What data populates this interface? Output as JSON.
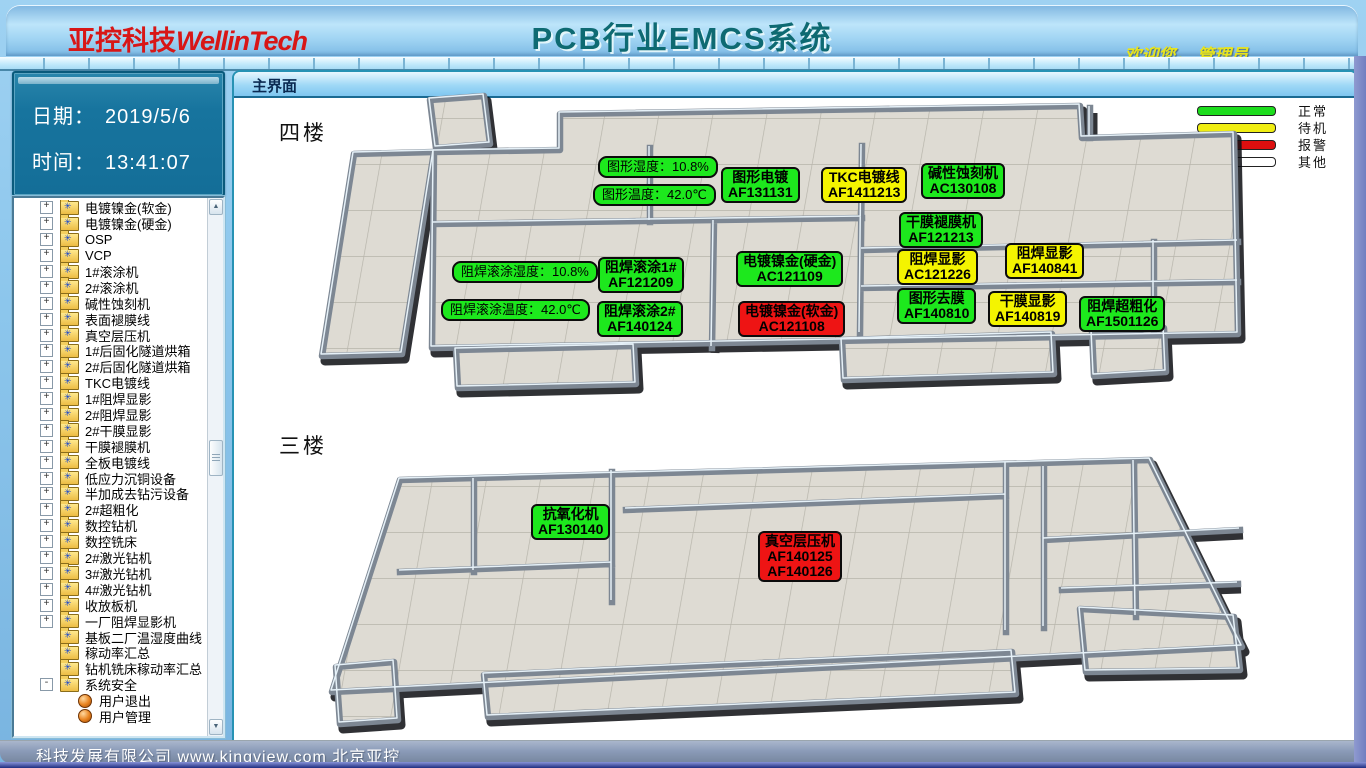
{
  "header": {
    "logo_cn": "亚控科技",
    "logo_en": "WellinTech",
    "title": "PCB行业EMCS系统",
    "welcome": "欢迎您， 管理员"
  },
  "info_panel": {
    "date_label": "日期：",
    "date_value": "2019/5/6",
    "time_label": "时间：",
    "time_value": "13:41:07"
  },
  "tree": {
    "items": [
      {
        "label": "电镀镍金(软金)",
        "icon": "folder",
        "expand": "plus"
      },
      {
        "label": "电镀镍金(硬金)",
        "icon": "folder",
        "expand": "plus"
      },
      {
        "label": "OSP",
        "icon": "folder",
        "expand": "plus"
      },
      {
        "label": "VCP",
        "icon": "folder",
        "expand": "plus"
      },
      {
        "label": "1#滚涂机",
        "icon": "folder",
        "expand": "plus"
      },
      {
        "label": "2#滚涂机",
        "icon": "folder",
        "expand": "plus"
      },
      {
        "label": "碱性蚀刻机",
        "icon": "folder",
        "expand": "plus"
      },
      {
        "label": "表面褪膜线",
        "icon": "folder",
        "expand": "plus"
      },
      {
        "label": "真空层压机",
        "icon": "folder",
        "expand": "plus"
      },
      {
        "label": "1#后固化隧道烘箱",
        "icon": "folder",
        "expand": "plus"
      },
      {
        "label": "2#后固化隧道烘箱",
        "icon": "folder",
        "expand": "plus"
      },
      {
        "label": "TKC电镀线",
        "icon": "folder",
        "expand": "plus"
      },
      {
        "label": "1#阻焊显影",
        "icon": "folder",
        "expand": "plus"
      },
      {
        "label": "2#阻焊显影",
        "icon": "folder",
        "expand": "plus"
      },
      {
        "label": "2#干膜显影",
        "icon": "folder",
        "expand": "plus"
      },
      {
        "label": "干膜褪膜机",
        "icon": "folder",
        "expand": "plus"
      },
      {
        "label": "全板电镀线",
        "icon": "folder",
        "expand": "plus"
      },
      {
        "label": "低应力沉铜设备",
        "icon": "folder",
        "expand": "plus"
      },
      {
        "label": "半加成去钻污设备",
        "icon": "folder",
        "expand": "plus"
      },
      {
        "label": "2#超粗化",
        "icon": "folder",
        "expand": "plus"
      },
      {
        "label": "数控钻机",
        "icon": "folder",
        "expand": "plus"
      },
      {
        "label": "数控铣床",
        "icon": "folder",
        "expand": "plus"
      },
      {
        "label": "2#激光钻机",
        "icon": "folder",
        "expand": "plus"
      },
      {
        "label": "3#激光钻机",
        "icon": "folder",
        "expand": "plus"
      },
      {
        "label": "4#激光钻机",
        "icon": "folder",
        "expand": "plus"
      },
      {
        "label": "收放板机",
        "icon": "folder",
        "expand": "plus"
      },
      {
        "label": "一厂阻焊显影机",
        "icon": "folder",
        "expand": "plus"
      },
      {
        "label": "基板二厂温湿度曲线",
        "icon": "folder",
        "expand": "none"
      },
      {
        "label": "稼动率汇总",
        "icon": "folder",
        "expand": "none"
      },
      {
        "label": "钻机铣床稼动率汇总",
        "icon": "folder",
        "expand": "none"
      },
      {
        "label": "系统安全",
        "icon": "folder",
        "expand": "minus"
      },
      {
        "label": "用户退出",
        "icon": "ball",
        "expand": "child"
      },
      {
        "label": "用户管理",
        "icon": "ball",
        "expand": "child"
      }
    ]
  },
  "main": {
    "tab_title": "主界面",
    "legend": [
      {
        "label": "正常",
        "color": "#1ddd1d"
      },
      {
        "label": "待机",
        "color": "#f0ee12"
      },
      {
        "label": "报警",
        "color": "#dd0f0f"
      },
      {
        "label": "其他",
        "color": "#ffffff"
      }
    ],
    "status_colors": {
      "normal": "#1de81d",
      "standby": "#f4f400",
      "alarm": "#ee1414",
      "other": "#ffffff"
    },
    "floors": [
      {
        "name": "四楼",
        "labels": [
          {
            "kind": "pill",
            "lines": [
              "图形湿度：10.8%"
            ],
            "status": "normal",
            "x": 598,
            "y": 156
          },
          {
            "kind": "pill",
            "lines": [
              "图形温度：42.0℃"
            ],
            "status": "normal",
            "x": 593,
            "y": 184
          },
          {
            "kind": "box",
            "lines": [
              "图形电镀",
              "AF131131"
            ],
            "status": "normal",
            "x": 721,
            "y": 167
          },
          {
            "kind": "box",
            "lines": [
              "TKC电镀线",
              "AF1411213"
            ],
            "status": "standby",
            "x": 821,
            "y": 167
          },
          {
            "kind": "box",
            "lines": [
              "碱性蚀刻机",
              "AC130108"
            ],
            "status": "normal",
            "x": 921,
            "y": 163
          },
          {
            "kind": "box",
            "lines": [
              "干膜褪膜机",
              "AF121213"
            ],
            "status": "normal",
            "x": 899,
            "y": 212
          },
          {
            "kind": "box",
            "lines": [
              "阻焊显影",
              "AC121226"
            ],
            "status": "standby",
            "x": 897,
            "y": 249
          },
          {
            "kind": "box",
            "lines": [
              "阻焊显影",
              "AF140841"
            ],
            "status": "standby",
            "x": 1005,
            "y": 243
          },
          {
            "kind": "box",
            "lines": [
              "图形去膜",
              "AF140810"
            ],
            "status": "normal",
            "x": 897,
            "y": 288
          },
          {
            "kind": "box",
            "lines": [
              "干膜显影",
              "AF140819"
            ],
            "status": "standby",
            "x": 988,
            "y": 291
          },
          {
            "kind": "box",
            "lines": [
              "阻焊超粗化",
              "AF1501126"
            ],
            "status": "normal",
            "x": 1079,
            "y": 296
          },
          {
            "kind": "pill",
            "lines": [
              "阻焊滚涂湿度：10.8%"
            ],
            "status": "normal",
            "x": 452,
            "y": 261
          },
          {
            "kind": "pill",
            "lines": [
              "阻焊滚涂温度：42.0℃"
            ],
            "status": "normal",
            "x": 441,
            "y": 299
          },
          {
            "kind": "box",
            "lines": [
              "阻焊滚涂1#",
              "AF121209"
            ],
            "status": "normal",
            "x": 598,
            "y": 257
          },
          {
            "kind": "box",
            "lines": [
              "阻焊滚涂2#",
              "AF140124"
            ],
            "status": "normal",
            "x": 597,
            "y": 301
          },
          {
            "kind": "box",
            "lines": [
              "电镀镍金(硬金)",
              "AC121109"
            ],
            "status": "normal",
            "x": 736,
            "y": 251
          },
          {
            "kind": "box",
            "lines": [
              "电镀镍金(软金)",
              "AC121108"
            ],
            "status": "alarm",
            "x": 738,
            "y": 301
          }
        ]
      },
      {
        "name": "三楼",
        "labels": [
          {
            "kind": "box",
            "lines": [
              "抗氧化机",
              "AF130140"
            ],
            "status": "normal",
            "x": 531,
            "y": 504
          },
          {
            "kind": "box",
            "lines": [
              "真空层压机",
              "AF140125",
              "AF140126"
            ],
            "status": "alarm",
            "x": 758,
            "y": 531
          }
        ]
      }
    ]
  },
  "footer": {
    "marquee": "科技发展有限公司 www.kingview.com 北京亚控"
  }
}
